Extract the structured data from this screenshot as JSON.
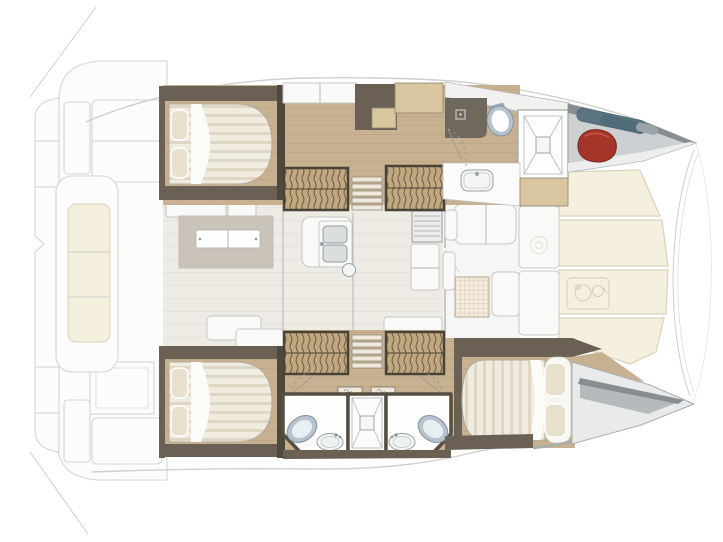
{
  "diagram": {
    "kind": "catamaran-interior-floor-plan",
    "view": "top-down",
    "orientation": {
      "bow": "right",
      "stern": "left"
    },
    "rooms": [
      "aft-cockpit",
      "swim-platform",
      "salon",
      "galley",
      "forward-cockpit",
      "foredeck-lounge",
      "port-aft-cabin",
      "port-forward-head",
      "starboard-aft-cabin",
      "starboard-forward-cabin",
      "starboard-bathrooms",
      "port-bow-locker",
      "starboard-bow-locker"
    ],
    "equipment": {
      "double_beds": 3,
      "toilets": 3,
      "shower_cubicles": 2,
      "shower_trays": 1,
      "washbasins": 4,
      "galley_sink_bowls": 2,
      "companionway_steps": 4,
      "salon_tables": 1,
      "stoves": 1,
      "fridges": 1,
      "cockpit_benches": 1,
      "foredeck_cushions": 6,
      "red_fenders": 1,
      "sail_bags": 1
    }
  },
  "colors": {
    "wood": "#c8b191",
    "wall_dark": "#4f483c",
    "wall_mid": "#6a6154",
    "cabinet_tan": "#d9c5a0",
    "mattress": "#f0ebdf",
    "mattress_stripe": "#dcd4bf",
    "pillow": "#e9e1cd",
    "sheet": "#fbfbf7",
    "salon_floor": "#edebe3",
    "platform": "#c9c3ba",
    "white_furniture": "#f9f9f7",
    "cream_cushion": "#f5efdd",
    "cushion_edge": "#d9d2bf",
    "deck_white": "#fcfcfb",
    "outline": "#d5d5d5",
    "tread": "#c2a87e",
    "locker_floor": "#cdd0d2",
    "locker_wall": "#878d90",
    "fender_red": "#a43529",
    "fender_dark": "#7c241c",
    "bag_blue": "#5d7583",
    "bag_blue_dark": "#4a636f",
    "toilet_rim": "#b6c3ce",
    "toilet_stroke": "#8494a0",
    "fixture_white": "#f4f5f5",
    "fixture_stroke": "#99a0a3",
    "grid_table": "#f3ebdc"
  }
}
